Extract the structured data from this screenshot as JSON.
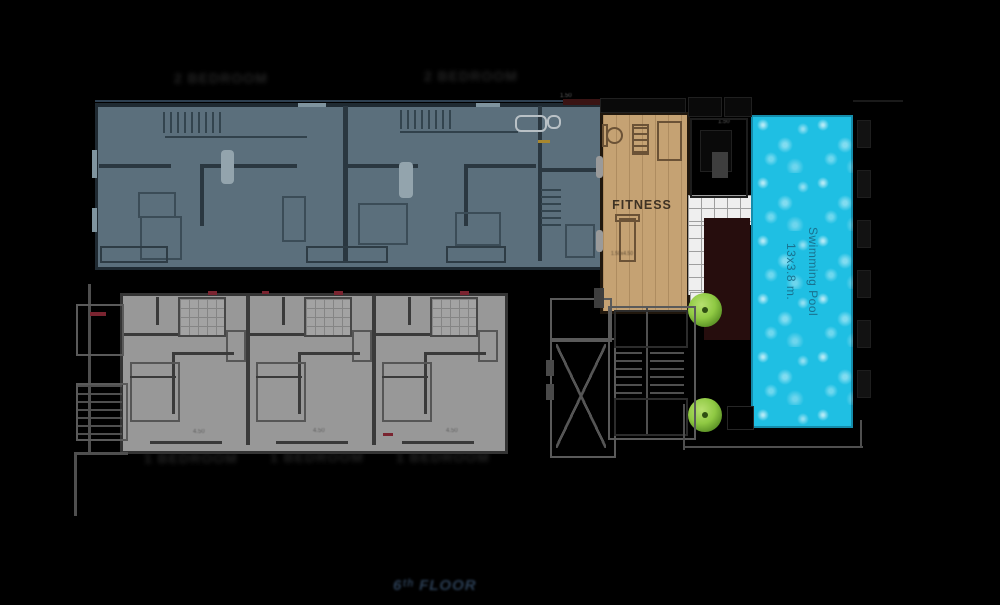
{
  "watermark": "6ᵗʰ FLOOR",
  "labels": {
    "top_unit_1": "2 BEDROOM",
    "top_unit_2": "2 BEDROOM",
    "bottom_unit_1": "1 BEDROOM",
    "bottom_unit_2": "1 BEDROOM",
    "bottom_unit_3": "1 BEDROOM"
  },
  "fitness": {
    "name": "FITNESS",
    "dim": "1.50x4.50"
  },
  "pool": {
    "name": "Swimming Pool",
    "size": "13x3.8 m."
  },
  "dims": {
    "top_1": "1.50",
    "top_2": "1.50",
    "bottom_1": "4.50",
    "bottom_2": "4.50",
    "bottom_3": "4.50"
  },
  "colors": {
    "background": "#000000",
    "unit_blue": "#5b6f7c",
    "unit_gray": "#989898",
    "fitness_wood": "#c5a273",
    "pool_water": "#1fbfe3",
    "tree_green": "#8fc943",
    "deck_maroon": "#260d0d",
    "tile_white": "#efefef",
    "watermark_navy": "#2b3e54"
  }
}
